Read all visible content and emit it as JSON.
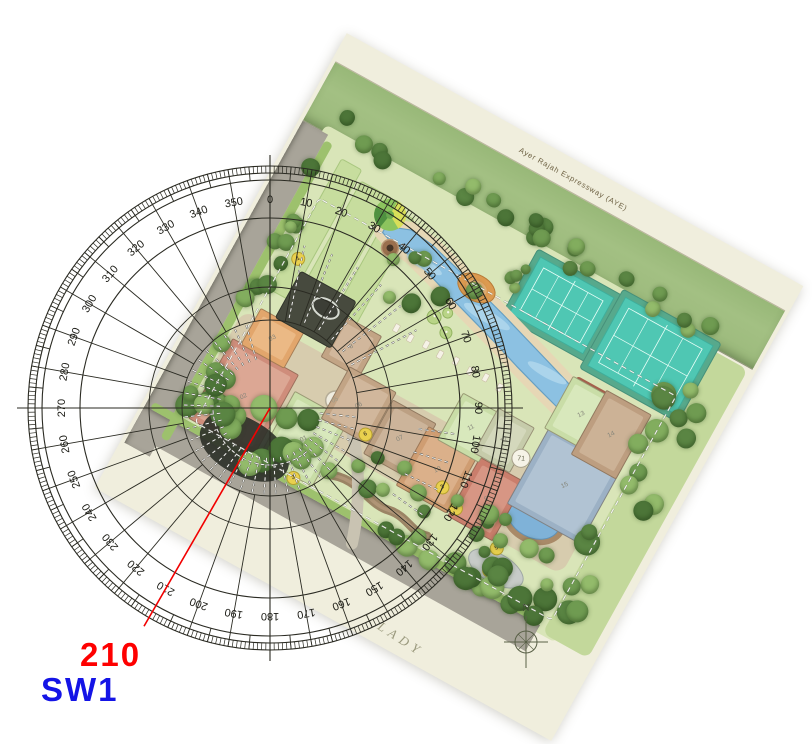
{
  "page": {
    "width": 812,
    "height": 744,
    "background": "#ffffff"
  },
  "readout": {
    "bearing": "210",
    "bearing_color": "#fe0000",
    "bearing_x": 80,
    "bearing_y": 638,
    "bearing_size": 33,
    "facing": "SW1",
    "facing_color": "#1414e6",
    "facing_x": 41,
    "facing_y": 673,
    "facing_size": 33
  },
  "north": {
    "label": "N",
    "x": 526,
    "y": 646
  },
  "compass": {
    "cx": 270,
    "cy": 408,
    "color": "#2a2a22",
    "label_color": "#1a1a14",
    "rings": [
      88,
      121,
      190,
      228,
      235,
      242
    ],
    "fine_ticks": {
      "step": 1,
      "r0": 235,
      "r1": 242,
      "width": 0.7
    },
    "mid_ticks": {
      "step": 5,
      "r0": 228,
      "r1": 242,
      "width": 0.9
    },
    "spokes": {
      "step": 10,
      "r0": 88,
      "r1": 228,
      "width": 0.9
    },
    "axes": {
      "r": 253,
      "width": 1.1
    },
    "labels": {
      "radius": 209,
      "font_px": 11,
      "values": [
        "0",
        "10",
        "20",
        "30",
        "40",
        "50",
        "60",
        "70",
        "80",
        "90",
        "100",
        "110",
        "120",
        "130",
        "140",
        "150",
        "160",
        "170",
        "180",
        "190",
        "200",
        "210",
        "220",
        "230",
        "240",
        "250",
        "260",
        "270",
        "280",
        "290",
        "300",
        "310",
        "320",
        "330",
        "340",
        "350"
      ]
    },
    "red_line": {
      "bearing_deg": 210,
      "r_end": 252,
      "color": "#f20000",
      "width": 1.6
    },
    "dash_fans": [
      {
        "a0": 96,
        "a1": 344,
        "step": 8,
        "r0": 50,
        "r1": 86
      },
      {
        "a0": 12,
        "a1": 64,
        "step": 10,
        "r0": 92,
        "r1": 166
      },
      {
        "a0": 98,
        "a1": 126,
        "step": 9,
        "r0": 150,
        "r1": 186
      }
    ],
    "dash_arcs": [
      {
        "r": 57,
        "a0": 140,
        "a1": 268
      }
    ]
  },
  "plan": {
    "paper": {
      "cx": 449,
      "cy": 387,
      "w": 522,
      "h": 520,
      "rot": 29,
      "color": "#f0eedd"
    },
    "aye_label": {
      "text": "Ayer Rajah Expressway (AYE)",
      "x": 269,
      "y": 18,
      "rot": 0,
      "size": 7.5,
      "color": "#6e6244"
    },
    "lady": {
      "text": "LADY",
      "x": 341,
      "y": 504,
      "rot": 4,
      "size": 13,
      "color": "#9a997d"
    },
    "strip": {
      "x": 4,
      "y": 30,
      "w": 514,
      "h": 66,
      "color": "#a3c083"
    },
    "interior": {
      "x": 26,
      "y": 90,
      "w": 452,
      "h": 342,
      "color": "#d9e5b8"
    },
    "lawn_right": {
      "x": 462,
      "y": 100,
      "w": 52,
      "h": 330,
      "color": "#c3d89b"
    },
    "roads": {
      "color": "#a8a499",
      "left": {
        "x": 4,
        "y": 98,
        "w": 29,
        "h": 368
      },
      "bottom": {
        "x": 4,
        "y": 424,
        "w": 452,
        "h": 30
      },
      "labels": [
        {
          "text": "Science Park Drive",
          "x": 19,
          "y": 269,
          "rot": -89
        },
        {
          "text": "Science Park Drive",
          "x": 254,
          "y": 437,
          "rot": -1
        }
      ],
      "label_color": "#8a8670",
      "label_size": 8
    },
    "verges": [
      {
        "x": 33,
        "y": 104,
        "w": 9,
        "h": 340,
        "c": "#9dc16d"
      },
      {
        "x": 10,
        "y": 416,
        "w": 440,
        "h": 8,
        "c": "#9dc16d"
      }
    ],
    "lawn_strips": [
      {
        "x": 56,
        "y": 112,
        "w": 22,
        "h": 148
      },
      {
        "x": 84,
        "y": 122,
        "w": 34,
        "h": 158
      },
      {
        "x": 124,
        "y": 130,
        "w": 24,
        "h": 148
      }
    ],
    "lawn_strip_color": "#c7dd9e",
    "carpark": {
      "x": 76,
      "y": 238,
      "w": 32,
      "h": 42,
      "c": "#a9a69b"
    },
    "spine": {
      "x": 44,
      "y": 292,
      "w": 406,
      "h": 78,
      "color": "#d7caad"
    },
    "courts": {
      "apron": "#57a98c",
      "surface": "#4fc7b3",
      "line": "#eafff8",
      "items": [
        {
          "x": 278,
          "y": 102,
          "w": 84,
          "h": 64
        },
        {
          "x": 372,
          "y": 96,
          "w": 100,
          "h": 78
        }
      ]
    },
    "pool": {
      "fill": "#8cc1e2",
      "stroke": "#679fc2",
      "deck": "#e6d7b5",
      "top": [
        [
          128,
          150
        ],
        [
          152,
          141
        ],
        [
          178,
          144
        ],
        [
          208,
          152
        ],
        [
          240,
          161
        ],
        [
          272,
          170
        ],
        [
          304,
          180
        ],
        [
          336,
          190
        ],
        [
          364,
          199
        ],
        [
          386,
          208
        ],
        [
          396,
          215
        ]
      ],
      "bottom": [
        [
          391,
          231
        ],
        [
          368,
          226
        ],
        [
          340,
          218
        ],
        [
          310,
          209
        ],
        [
          280,
          199
        ],
        [
          250,
          190
        ],
        [
          220,
          181
        ],
        [
          192,
          172
        ],
        [
          164,
          164
        ],
        [
          142,
          162
        ],
        [
          128,
          157
        ]
      ]
    },
    "spa": {
      "cx": 402,
      "cy": 203,
      "rx": 26,
      "ry": 8,
      "deck": {
        "x": 368,
        "y": 188,
        "w": 34,
        "h": 26,
        "c": "#a4604c"
      }
    },
    "ponds": {
      "blue": {
        "cx": 398,
        "cy": 332,
        "rx": 28,
        "ry": 21,
        "bank": "#a98a68",
        "water": "#7fb2d8"
      },
      "grey": {
        "cx": 390,
        "cy": 396,
        "rx": 30,
        "ry": 15,
        "water": "#c7cbc8"
      }
    },
    "stream": {
      "d": "M 196,396 C 226,382 246,402 268,397 C 288,393 298,406 314,401",
      "c": "#8b6b50"
    },
    "driveway": {
      "d": "M 252,444 C 240,404 216,362 188,336",
      "c": "#c9c3b2"
    },
    "roundabout": {
      "cx": 168,
      "cy": 327,
      "r": 9.5,
      "label": "05"
    },
    "playground": {
      "cx": 237,
      "cy": 160,
      "rx": 20,
      "ry": 13,
      "c": "#dc9a50",
      "c2": "#e8b277"
    },
    "feature_circle": {
      "cx": 126,
      "cy": 138,
      "r": 16,
      "green": "#8cc45e",
      "yellow": "#d9df59",
      "dark": "#4f9140"
    },
    "plaza": {
      "cx": 142,
      "cy": 167,
      "r": 8.5,
      "c": "#9a6f4e",
      "center": "#463426"
    },
    "mounds": [
      [
        214,
        206,
        7
      ],
      [
        232,
        214,
        6
      ],
      [
        224,
        196,
        5
      ]
    ],
    "loungers": {
      "x0": 184,
      "y0": 230,
      "step": 17,
      "n": 8,
      "w": 5,
      "h": 8
    },
    "boundary_dash": {
      "x": 56,
      "y": 158,
      "w": 408,
      "h": 256
    },
    "buildings": [
      {
        "n": "02",
        "x": 48,
        "y": 322,
        "w": 74,
        "h": 90,
        "c": "#cf8d7b",
        "c2": "#dca794"
      },
      {
        "n": "01",
        "x": 128,
        "y": 338,
        "w": 60,
        "h": 74,
        "c": "#c9dda7",
        "c2": "#d8e8bc"
      },
      {
        "n": "03",
        "x": 58,
        "y": 282,
        "w": 48,
        "h": 40,
        "c": "#e2a66c",
        "c2": "#ebb985"
      },
      {
        "n": "8",
        "x": 134,
        "y": 248,
        "w": 42,
        "h": 46,
        "c": "#c2a485",
        "c2": "#d1b79c"
      },
      {
        "n": "06",
        "x": 164,
        "y": 290,
        "w": 52,
        "h": 58,
        "c": "#c2a485",
        "c2": "#d1b79c"
      },
      {
        "n": "07",
        "x": 218,
        "y": 298,
        "w": 48,
        "h": 60,
        "c": "#bca083",
        "c2": "#ccb49a"
      },
      {
        "n": "10",
        "x": 262,
        "y": 304,
        "w": 56,
        "h": 66,
        "c": "#cf9d72",
        "c2": "#dbb08a"
      },
      {
        "n": "9",
        "x": 322,
        "y": 306,
        "w": 50,
        "h": 66,
        "c": "#ca7e6c",
        "c2": "#d79684"
      },
      {
        "n": "15",
        "x": 368,
        "y": 246,
        "w": 82,
        "h": 86,
        "c": "#9cb1c5",
        "c2": "#b1c3d3"
      },
      {
        "n": "11",
        "x": 276,
        "y": 258,
        "w": 46,
        "h": 52,
        "c": "#c9dda7",
        "c2": "#d8e8bc"
      },
      {
        "n": "12",
        "x": 314,
        "y": 254,
        "w": 40,
        "h": 50,
        "c": "#c6cbaa",
        "c2": "#d4d8bc"
      },
      {
        "n": "13",
        "x": 364,
        "y": 190,
        "w": 50,
        "h": 58,
        "c": "#c9dda7",
        "c2": "#d8e8bc"
      },
      {
        "n": "14",
        "x": 400,
        "y": 186,
        "w": 50,
        "h": 72,
        "c": "#bd9e80",
        "c2": "#ccb296"
      }
    ],
    "deck_dark": {
      "x": 75,
      "y": 230,
      "w": 62,
      "h": 52,
      "c": "#474a3e",
      "oval": {
        "cx": 112,
        "cy": 248,
        "rx": 13,
        "ry": 8
      }
    },
    "shadow_blob": {
      "x": 64,
      "y": 384,
      "w": 96,
      "h": 56,
      "c": "#2f322a"
    },
    "badges": [
      {
        "t": "1",
        "x": 66,
        "y": 220
      },
      {
        "t": "6",
        "x": 210,
        "y": 341
      },
      {
        "t": "3",
        "x": 303,
        "y": 350
      },
      {
        "t": "4",
        "x": 325,
        "y": 362
      },
      {
        "t": "3",
        "x": 168,
        "y": 414
      },
      {
        "t": "5",
        "x": 380,
        "y": 377
      },
      {
        "t": "5",
        "x": 384,
        "y": 400
      },
      {
        "t": "2",
        "x": 445,
        "y": 403
      }
    ],
    "white_badge": {
      "t": "71",
      "x": 358,
      "y": 287
    },
    "tree_palette": [
      "#6f9b51",
      "#82ad5e",
      "#5a8543",
      "#93bb6b",
      "#4c7538"
    ],
    "tree_clusters": [
      {
        "x": 30,
        "y": 72,
        "w": 440,
        "h": 26,
        "n": 24,
        "r0": 6,
        "r1": 10,
        "seed": 11
      },
      {
        "x": 452,
        "y": 130,
        "w": 50,
        "h": 300,
        "n": 18,
        "r0": 8,
        "r1": 14,
        "seed": 22
      },
      {
        "x": 34,
        "y": 386,
        "w": 430,
        "h": 40,
        "n": 26,
        "r0": 8,
        "r1": 13,
        "seed": 33
      },
      {
        "x": 30,
        "y": 110,
        "w": 24,
        "h": 300,
        "n": 14,
        "r0": 6,
        "r1": 10,
        "seed": 44
      },
      {
        "x": 52,
        "y": 352,
        "w": 120,
        "h": 58,
        "n": 13,
        "r0": 9,
        "r1": 14,
        "seed": 55
      },
      {
        "x": 150,
        "y": 160,
        "w": 100,
        "h": 70,
        "n": 7,
        "r0": 6,
        "r1": 10,
        "seed": 66
      },
      {
        "x": 352,
        "y": 336,
        "w": 110,
        "h": 56,
        "n": 9,
        "r0": 6,
        "r1": 10,
        "seed": 77
      },
      {
        "x": 196,
        "y": 352,
        "w": 130,
        "h": 40,
        "n": 8,
        "r0": 6,
        "r1": 9,
        "seed": 88
      },
      {
        "x": 222,
        "y": 120,
        "w": 60,
        "h": 40,
        "n": 4,
        "r0": 5,
        "r1": 8,
        "seed": 99
      }
    ]
  }
}
